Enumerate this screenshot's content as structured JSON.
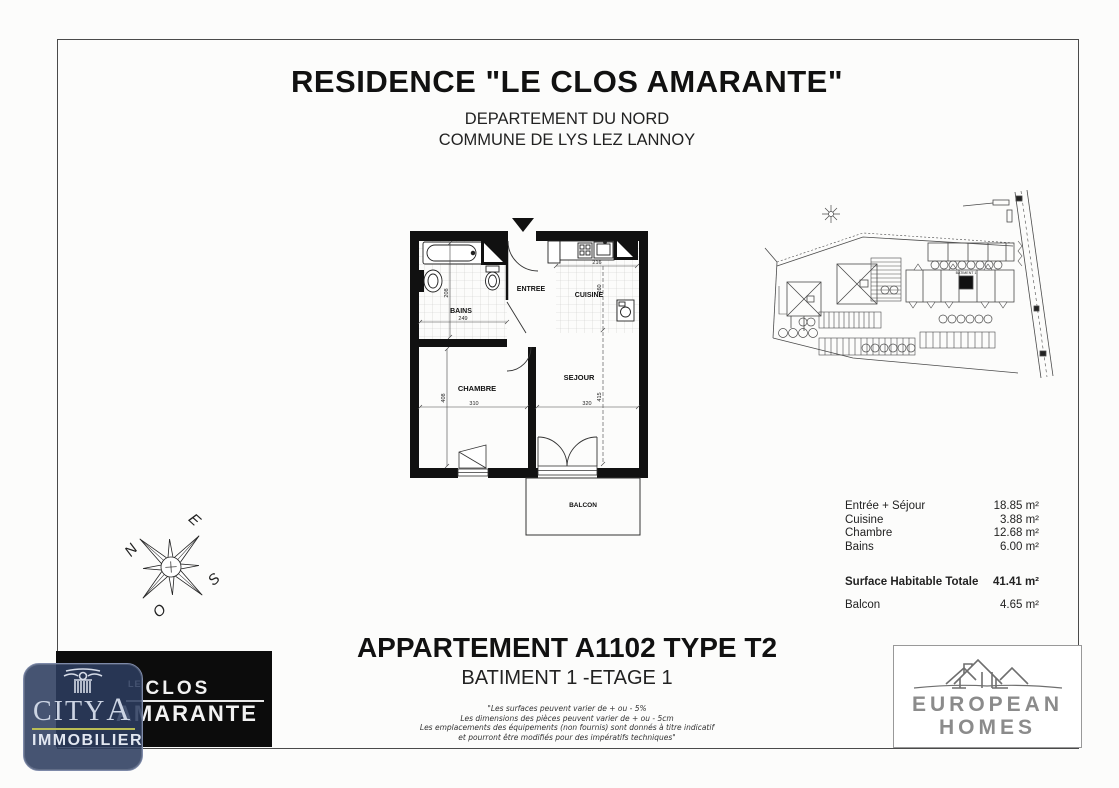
{
  "header": {
    "title": "RESIDENCE \"LE CLOS AMARANTE\"",
    "subtitle1": "DEPARTEMENT DU NORD",
    "subtitle2": "COMMUNE DE LYS LEZ LANNOY"
  },
  "floor_plan": {
    "rooms": {
      "bains": "BAINS",
      "entree": "ENTREE",
      "cuisine": "CUISINE",
      "chambre": "CHAMBRE",
      "sejour": "SEJOUR",
      "balcon": "BALCON"
    },
    "dims": {
      "bains_w": "249",
      "bains_d": "208",
      "cuisine_w": "216",
      "cuisine_d": "260",
      "chambre_w": "310",
      "chambre_d": "408",
      "sejour_w": "320",
      "sejour_d": "415"
    }
  },
  "site_plan": {
    "batiment_label": "BATIMENT 1"
  },
  "compass": {
    "n": "N",
    "e": "E",
    "s": "S",
    "o": "O"
  },
  "areas": {
    "rows": [
      {
        "label": "Entrée + Séjour",
        "value": "18.85 m²"
      },
      {
        "label": "Cuisine",
        "value": "3.88 m²"
      },
      {
        "label": "Chambre",
        "value": "12.68 m²"
      },
      {
        "label": "Bains",
        "value": "6.00 m²"
      }
    ],
    "total_label": "Surface Habitable Totale",
    "total_value": "41.41 m²",
    "balcon_label": "Balcon",
    "balcon_value": "4.65 m²"
  },
  "apartment": {
    "title": "APPARTEMENT A1102 TYPE T2",
    "subtitle": "BATIMENT 1 -ETAGE 1",
    "disclaimer": [
      "\"Les surfaces peuvent varier de + ou - 5%",
      "Les dimensions des pièces peuvent varier de + ou - 5cm",
      "Les emplacements des équipements (non fournis) sont donnés à titre indicatif",
      "et pourront être modifiés pour des impératifs techniques\""
    ]
  },
  "logos": {
    "clos": {
      "prefix": "LE",
      "line1": "CLOS",
      "line2": "AMARANTE"
    },
    "citya": {
      "part1": "CITY",
      "part2": "A",
      "line2": "IMMOBILIER",
      "bg_color": "#2c3c5f",
      "accent_color": "#b9bd55"
    },
    "european_homes": {
      "line1": "EUROPEAN",
      "line2": "HOMES",
      "color": "#8b8b8b"
    }
  }
}
